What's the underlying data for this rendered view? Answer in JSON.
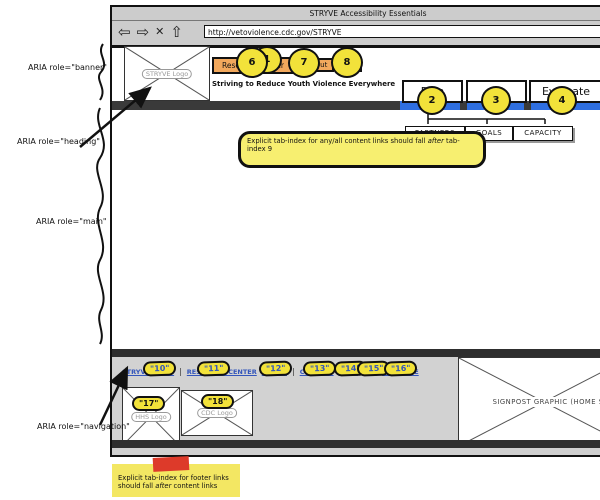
{
  "colors": {
    "oval_yellow": "#f2e23a",
    "button_orange": "#f2a85c",
    "bar_blue": "#2f6fe0",
    "link_blue": "#3355bb",
    "note_yellow": "#f7ef70",
    "tape_red": "#dd3a2a",
    "chrome_gray": "#cccccc"
  },
  "window": {
    "title": "STRYVE Accessibility Essentials",
    "url": "http://vetoviolence.cdc.gov/STRYVE",
    "toolbar": {
      "back_glyph": "⇦",
      "forward_glyph": "⇨",
      "stop_glyph": "✕",
      "home_glyph": "⇧"
    }
  },
  "banner": {
    "logo_label": "STRYVE Logo",
    "logo_tabindex": "1",
    "tagline": "Striving to Reduce Youth Violence Everywhere",
    "buttons": [
      {
        "label": "Resource Center",
        "tabindex": "6"
      },
      {
        "label": "About",
        "tabindex": "7"
      },
      {
        "label": "Contact",
        "tabindex": "8"
      }
    ]
  },
  "nav": {
    "tabs": [
      {
        "label": "Plan",
        "tabindex": "2"
      },
      {
        "label": "Act",
        "tabindex": "3"
      },
      {
        "label": "Evaluate",
        "tabindex": "4"
      }
    ],
    "subnav": [
      "PARTNERS",
      "GOALS",
      "CAPACITY"
    ]
  },
  "annotations": {
    "banner": "ARIA role=\"banner\"",
    "heading": "ARIA role=\"heading\"",
    "main": "ARIA role=\"main\"",
    "navigation": "ARIA role=\"navigation\"",
    "content_note": {
      "pre": "Explicit tab-index for any/all content links should fall ",
      "em": "after",
      "post": " tab-index 9"
    },
    "footer_note": {
      "pre": "Explicit tab-index for footer links should fall ",
      "em": "after",
      "post": " content links"
    }
  },
  "footer": {
    "separator": "|",
    "links": [
      {
        "label": "STRYVE HOME",
        "tabindex": "\"10\""
      },
      {
        "label": "RESOURCE CENTER",
        "tabindex": "\"11\""
      },
      {
        "label": "ABOUT",
        "tabindex": "\"12\""
      },
      {
        "label": "CONTACT",
        "tabindex": "\"13\""
      },
      {
        "label": "PLAN",
        "tabindex": "\"14\""
      },
      {
        "label": "ACT",
        "tabindex": "\"15\""
      },
      {
        "label": "EVALUATE",
        "tabindex": "\"16\""
      }
    ],
    "logos": [
      {
        "label": "HHS Logo",
        "tabindex": "\"17\""
      },
      {
        "label": "CDC Logo",
        "tabindex": "\"18\""
      }
    ],
    "signpost_label": "SIGNPOST GRAPHIC (HOME SCREEN)"
  }
}
